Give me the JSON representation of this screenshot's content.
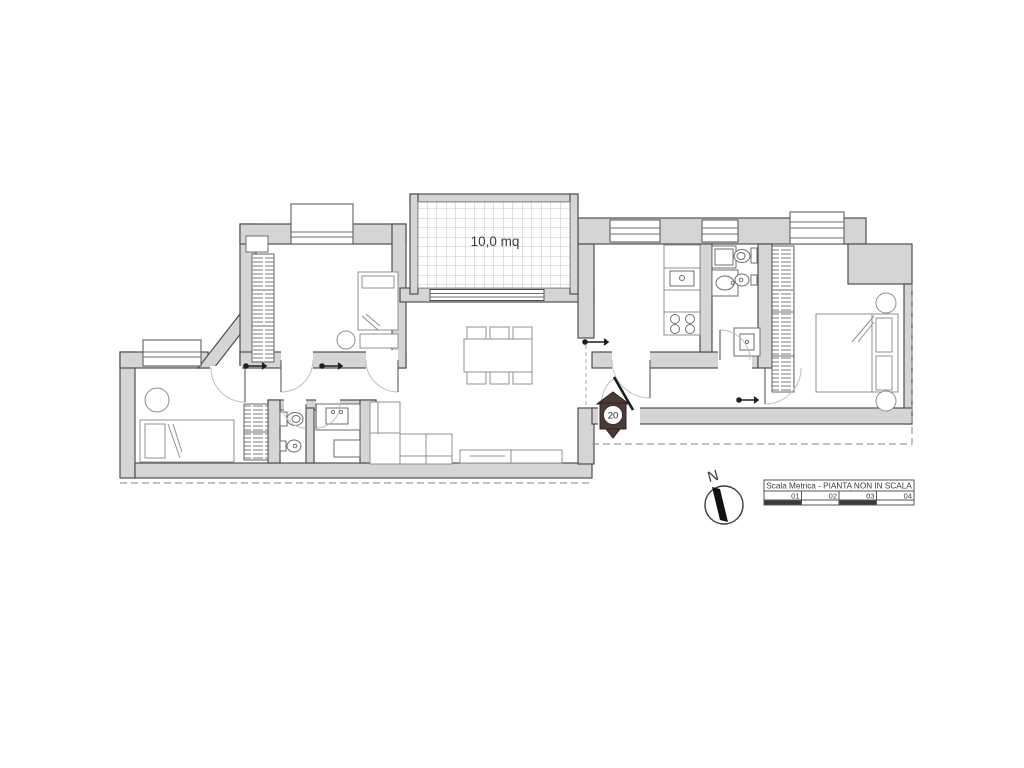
{
  "plan": {
    "area_label": "10,0 mq",
    "entrance_marker": "20",
    "compass_label": "N"
  },
  "scale_bar": {
    "title": "Scala Metrica - PIANTA NON IN SCALA",
    "ticks": [
      "01",
      "02",
      "03",
      "04"
    ]
  },
  "colors": {
    "wall_fill": "#d5d5d5",
    "wall_stroke": "#4f4f4f",
    "marker_fill": "#4d3935",
    "furniture_stroke": "#909090",
    "dashed_line": "#9a9a9a",
    "text": "#3a3a3a"
  }
}
